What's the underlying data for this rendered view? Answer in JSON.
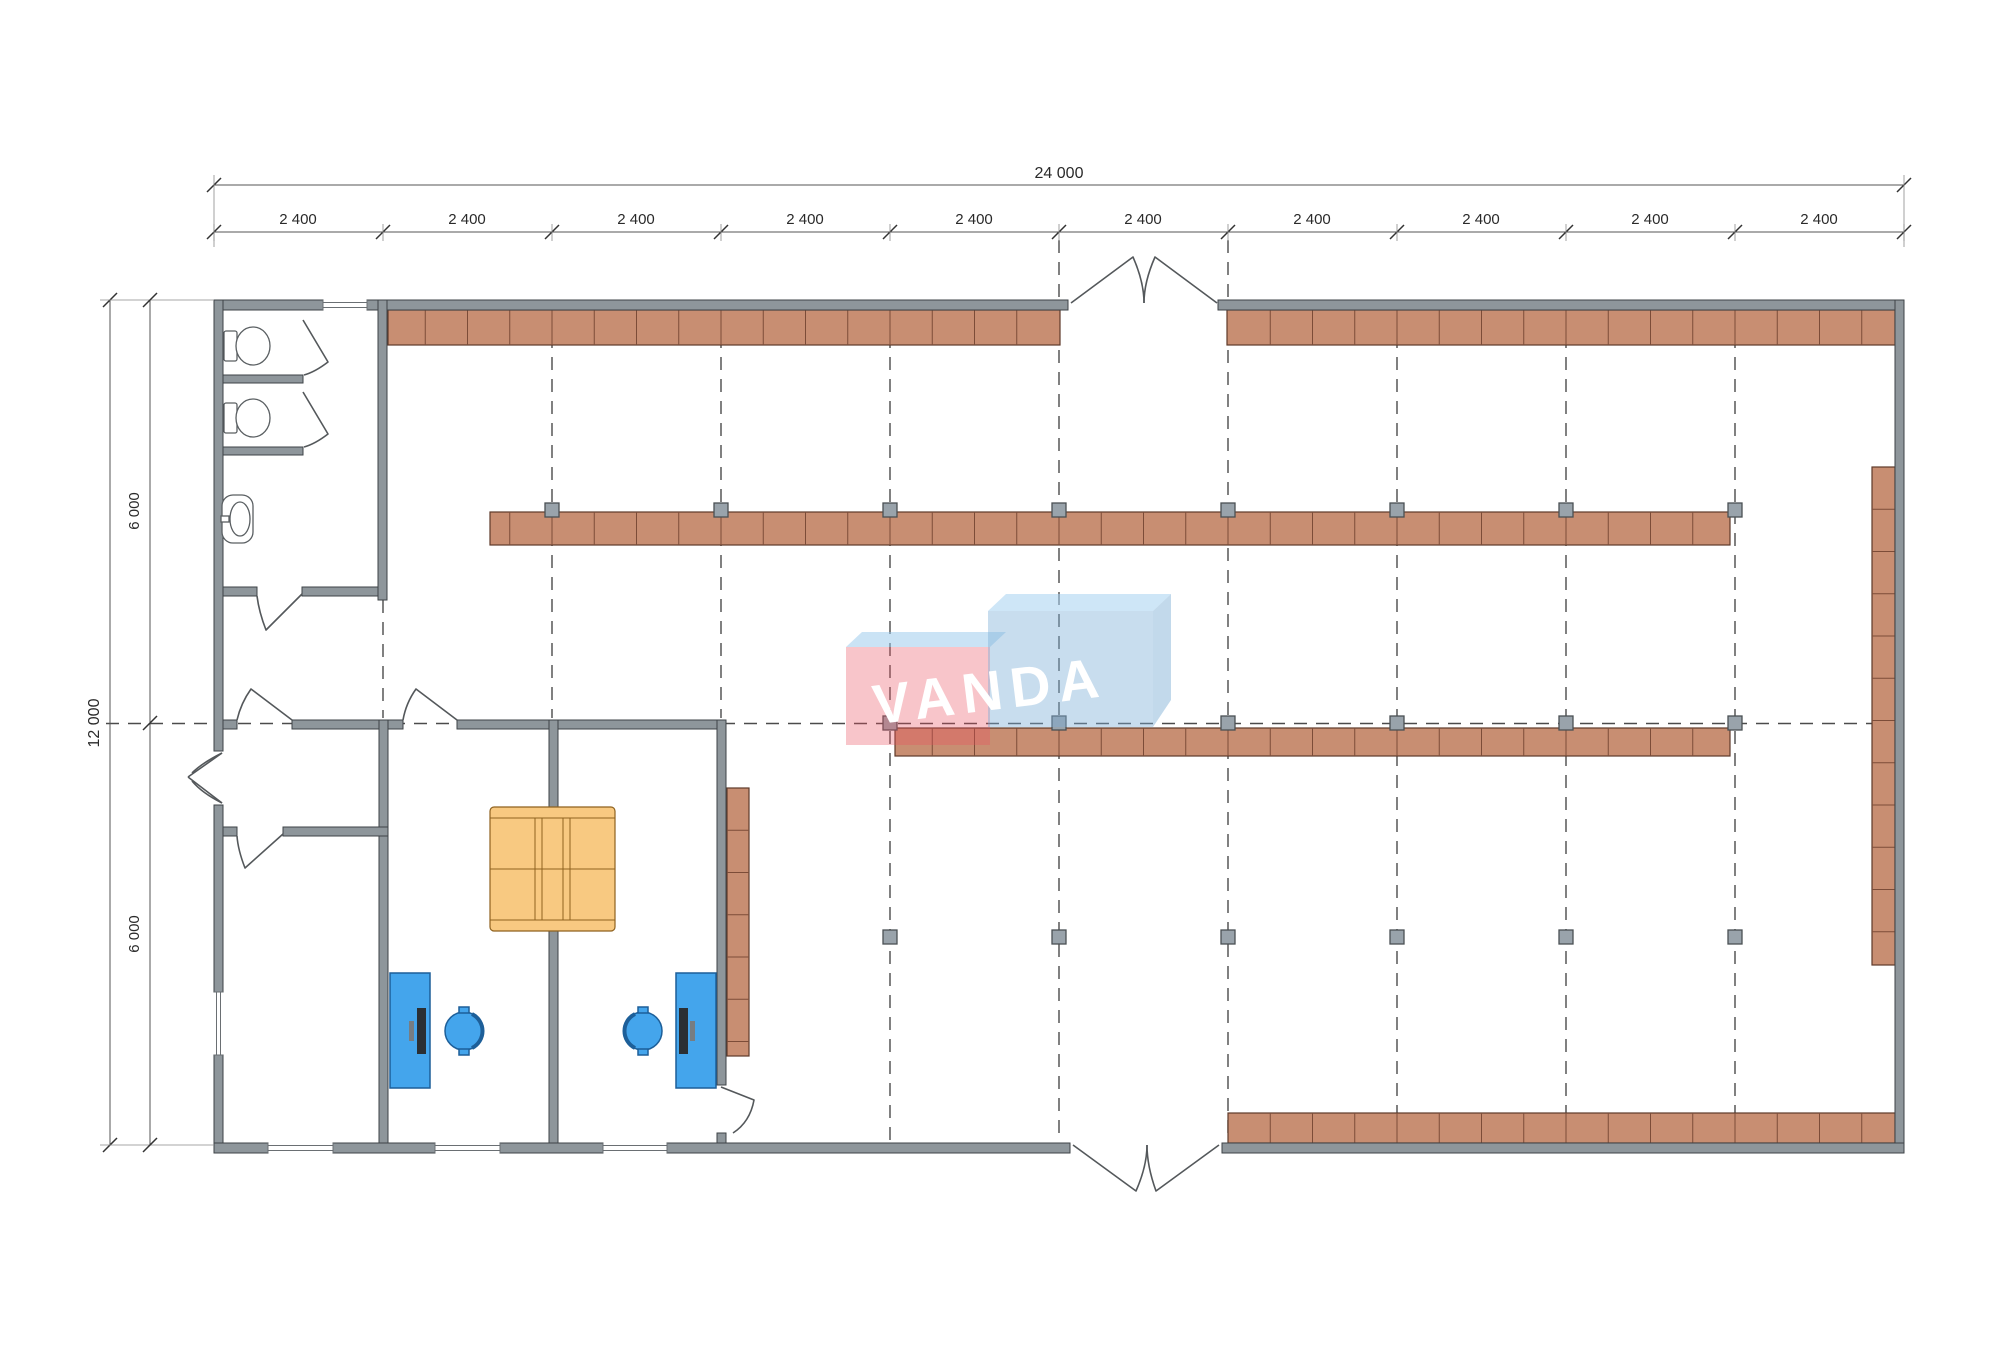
{
  "watermark": {
    "text": "VANDA",
    "pink_fill": "rgba(233,80,95,0.33)",
    "blue_fill": "rgba(125,175,215,0.42)",
    "pink_top_fill": "rgba(150,200,235,0.50)",
    "blue_top_fill": "rgba(165,210,240,0.55)",
    "blue_side_fill": "rgba(120,170,210,0.45)",
    "pink_box": {
      "x": 846,
      "y": 647,
      "w": 144,
      "h": 98
    },
    "blue_box": {
      "x": 988,
      "y": 611,
      "w": 165,
      "h": 116
    },
    "pink_top": "846,647 862,632 1006,632 990,647",
    "blue_top": "988,611 1006,594 1171,594 1153,611",
    "blue_side": "1153,611 1171,594 1171,700 1153,727",
    "text_x": 992,
    "text_y": 710,
    "text_rotate": -7
  },
  "colors": {
    "wall": "#8e969b",
    "shelf": "#c88e72",
    "shelf_border": "#5e3a2a",
    "column": "#99a3ab",
    "desk": "#44a5ec",
    "couch": "#f8c981",
    "grid": "#4b4b4b",
    "dim_text": "#2a2a2a"
  },
  "dims": {
    "top_total": {
      "label": "24 000",
      "y": 185,
      "x1": 214,
      "x2": 1904,
      "label_x": 1059,
      "label_y": 178
    },
    "top_segments": {
      "y": 232,
      "ticks": [
        214,
        383,
        552,
        721,
        890,
        1059,
        1228,
        1397,
        1566,
        1735,
        1904
      ],
      "labels": [
        {
          "text": "2 400",
          "x": 298
        },
        {
          "text": "2 400",
          "x": 467
        },
        {
          "text": "2 400",
          "x": 636
        },
        {
          "text": "2 400",
          "x": 805
        },
        {
          "text": "2 400",
          "x": 974
        },
        {
          "text": "2 400",
          "x": 1143
        },
        {
          "text": "2 400",
          "x": 1312
        },
        {
          "text": "2 400",
          "x": 1481
        },
        {
          "text": "2 400",
          "x": 1650
        },
        {
          "text": "2 400",
          "x": 1819
        }
      ]
    },
    "left_total": {
      "label": "12 000",
      "x": 110,
      "y1": 300,
      "y2": 1145,
      "label_x": 99,
      "label_y": 723
    },
    "left_segments": {
      "x": 150,
      "ticks": [
        300,
        723,
        1145
      ],
      "label_x": 139,
      "labels": [
        {
          "text": "6 000",
          "y": 511
        },
        {
          "text": "6 000",
          "y": 934
        }
      ]
    }
  },
  "plan": {
    "grid_dashed_v": [
      {
        "x": 383,
        "y1": 600,
        "y2": 718
      },
      {
        "x": 552,
        "y1": 313,
        "y2": 718
      },
      {
        "x": 721,
        "y1": 313,
        "y2": 718
      },
      {
        "x": 890,
        "y1": 313,
        "y2": 1141
      },
      {
        "x": 1059,
        "y1": 240,
        "y2": 1141
      },
      {
        "x": 1228,
        "y1": 240,
        "y2": 1141
      },
      {
        "x": 1397,
        "y1": 313,
        "y2": 1141
      },
      {
        "x": 1566,
        "y1": 313,
        "y2": 1141
      },
      {
        "x": 1735,
        "y1": 313,
        "y2": 1141
      }
    ],
    "grid_dashed_h": {
      "y": 723.5,
      "x1": 106,
      "x2": 1893
    },
    "shelves": [
      {
        "x": 388,
        "y": 310,
        "w": 672,
        "h": 35,
        "o": "h"
      },
      {
        "x": 1227,
        "y": 310,
        "w": 668,
        "h": 35,
        "o": "h"
      },
      {
        "x": 490,
        "y": 512,
        "w": 1240,
        "h": 33,
        "o": "h"
      },
      {
        "x": 895,
        "y": 728,
        "w": 835,
        "h": 28,
        "o": "h"
      },
      {
        "x": 1228,
        "y": 1113,
        "w": 667,
        "h": 30,
        "o": "h"
      },
      {
        "x": 1872,
        "y": 467,
        "w": 23,
        "h": 498,
        "o": "v"
      },
      {
        "x": 727,
        "y": 788,
        "w": 22,
        "h": 268,
        "o": "v"
      }
    ],
    "walls": [
      {
        "x": 214,
        "y": 300,
        "w": 109,
        "h": 10
      },
      {
        "x": 367,
        "y": 300,
        "w": 701,
        "h": 10
      },
      {
        "x": 1218,
        "y": 300,
        "w": 686,
        "h": 10
      },
      {
        "x": 214,
        "y": 300,
        "w": 9,
        "h": 451
      },
      {
        "x": 214,
        "y": 805,
        "w": 9,
        "h": 187
      },
      {
        "x": 214,
        "y": 1055,
        "w": 9,
        "h": 98
      },
      {
        "x": 1895,
        "y": 300,
        "w": 9,
        "h": 853
      },
      {
        "x": 214,
        "y": 1143,
        "w": 54,
        "h": 10
      },
      {
        "x": 333,
        "y": 1143,
        "w": 102,
        "h": 10
      },
      {
        "x": 500,
        "y": 1143,
        "w": 103,
        "h": 10
      },
      {
        "x": 667,
        "y": 1143,
        "w": 403,
        "h": 10
      },
      {
        "x": 1222,
        "y": 1143,
        "w": 682,
        "h": 10
      },
      {
        "x": 378,
        "y": 300,
        "w": 9,
        "h": 300
      },
      {
        "x": 223,
        "y": 587,
        "w": 34,
        "h": 9
      },
      {
        "x": 302,
        "y": 587,
        "w": 76,
        "h": 9
      },
      {
        "x": 223,
        "y": 375,
        "w": 80,
        "h": 8
      },
      {
        "x": 223,
        "y": 447,
        "w": 80,
        "h": 8
      },
      {
        "x": 223,
        "y": 720,
        "w": 14,
        "h": 9
      },
      {
        "x": 292,
        "y": 720,
        "w": 111,
        "h": 9
      },
      {
        "x": 457,
        "y": 720,
        "w": 269,
        "h": 9
      },
      {
        "x": 379,
        "y": 720,
        "w": 9,
        "h": 423
      },
      {
        "x": 549,
        "y": 720,
        "w": 9,
        "h": 423
      },
      {
        "x": 717,
        "y": 720,
        "w": 9,
        "h": 365
      },
      {
        "x": 717,
        "y": 1133,
        "w": 9,
        "h": 10
      },
      {
        "x": 223,
        "y": 827,
        "w": 14,
        "h": 9
      },
      {
        "x": 283,
        "y": 827,
        "w": 105,
        "h": 9
      }
    ],
    "windows": [
      {
        "x": 323,
        "y": 300,
        "w": 44,
        "h": 10,
        "o": "h"
      },
      {
        "x": 268,
        "y": 1143,
        "w": 65,
        "h": 10,
        "o": "h"
      },
      {
        "x": 435,
        "y": 1143,
        "w": 65,
        "h": 10,
        "o": "h"
      },
      {
        "x": 603,
        "y": 1143,
        "w": 64,
        "h": 10,
        "o": "h"
      },
      {
        "x": 214,
        "y": 992,
        "w": 9,
        "h": 63,
        "o": "v"
      }
    ],
    "column_rows": [
      {
        "y": 510,
        "xs": [
          552,
          721,
          890,
          1059,
          1228,
          1397,
          1566,
          1735
        ]
      },
      {
        "y": 723,
        "xs": [
          890,
          1059,
          1228,
          1397,
          1566,
          1735
        ]
      },
      {
        "y": 937,
        "xs": [
          890,
          1059,
          1228,
          1397,
          1566,
          1735
        ]
      }
    ],
    "doors": [
      {
        "name": "main-entrance-north-door",
        "d": "M1071 303 L1133 257 Q1144 282 1144 303"
      },
      {
        "name": "main-entrance-north-door",
        "d": "M1217 303 L1155 257 Q1144 282 1144 303"
      },
      {
        "name": "main-entrance-south-door",
        "d": "M1073 1145 L1136 1191 Q1147 1166 1147 1145"
      },
      {
        "name": "main-entrance-south-door",
        "d": "M1219 1145 L1156 1191 Q1147 1166 1147 1145"
      },
      {
        "name": "west-entrance-door",
        "d": "M222 753 L188 777 M222 803 L188 777"
      },
      {
        "name": "west-entrance-door",
        "d": "M222 753 Q202 763 192 773 M222 803 Q202 793 192 781"
      },
      {
        "name": "wc-room-door",
        "d": "M302 594 L266 630 Q259 612 257 596"
      },
      {
        "name": "wc-stall-door",
        "d": "M303 320 L328 362 Q315 372 304 375"
      },
      {
        "name": "wc-stall-door",
        "d": "M303 392 L328 434 Q315 444 304 447"
      },
      {
        "name": "hall-door",
        "d": "M292 720 L251 689 Q241 703 237 720"
      },
      {
        "name": "office1-door",
        "d": "M457 720 L416 689 Q406 703 403 720"
      },
      {
        "name": "storage-room-door",
        "d": "M283 834 L245 868 Q238 850 237 836"
      },
      {
        "name": "office2-side-door",
        "d": "M721 1087 L754 1100 Q750 1122 733 1133"
      }
    ],
    "desks": [
      {
        "x": 390,
        "y": 973,
        "w": 40,
        "h": 115,
        "monitor_x": 417
      },
      {
        "x": 676,
        "y": 973,
        "w": 40,
        "h": 115,
        "monitor_x": 679
      }
    ],
    "chairs": [
      {
        "cx": 464,
        "cy": 1031,
        "r": 19,
        "back": "right"
      },
      {
        "cx": 643,
        "cy": 1031,
        "r": 19,
        "back": "left"
      }
    ],
    "couch": {
      "x": 490,
      "y": 807,
      "w": 125,
      "h": 124
    },
    "toilets": [
      {
        "tx": 224,
        "ty": 331,
        "cx": 253,
        "cy": 346
      },
      {
        "tx": 224,
        "ty": 403,
        "cx": 253,
        "cy": 418
      }
    ],
    "sink": {
      "x": 222,
      "y": 495,
      "w": 31,
      "h": 48
    }
  }
}
